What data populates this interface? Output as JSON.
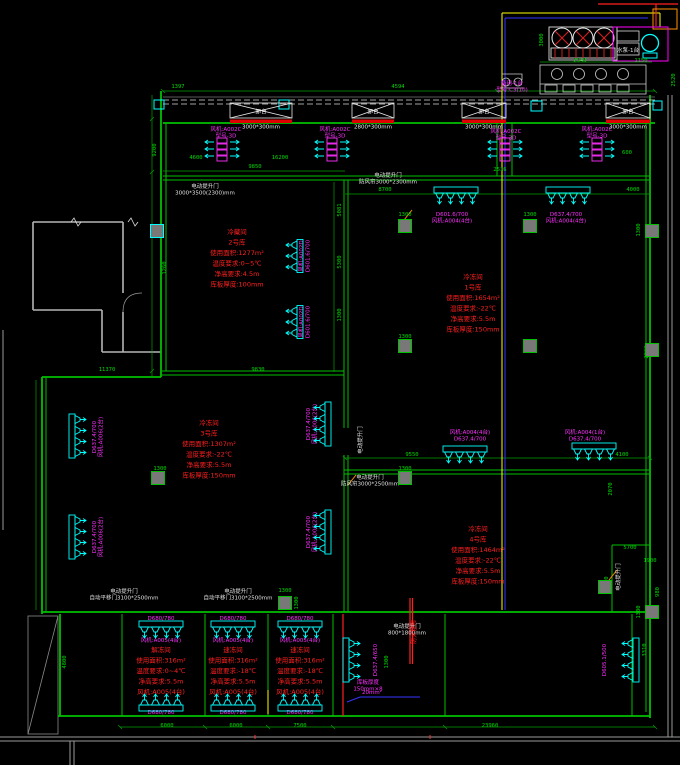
{
  "colors": {
    "background": "#000000",
    "wall_green": "#00c000",
    "dim_green": "#00dc00",
    "equipment_cyan": "#00ffff",
    "fan_magenta": "#ff30ff",
    "spec_red": "#ff2020",
    "note_white": "#e2e2e2",
    "road_gray": "#9a9a9a",
    "pipe_yellow": "#ffff00",
    "pipe_blue": "#3535ff",
    "pipe_red": "#ff2020",
    "pipe_orange": "#ff9000",
    "dock_bar_red": "#e00000"
  },
  "dock": {
    "bay_label": "卸台",
    "bays": [
      {
        "x": 230,
        "w": 62,
        "size": "3000*300mm"
      },
      {
        "x": 352,
        "w": 42,
        "size": "2800*300mm"
      },
      {
        "x": 462,
        "w": 44,
        "size": "3000*300mm"
      },
      {
        "x": 606,
        "w": 44,
        "size": "3000*300mm"
      }
    ]
  },
  "room_specs": [
    {
      "x": 237,
      "y": 234,
      "lines": [
        "冷藏间",
        "2号库",
        "使用面积:1277m²",
        "温度要求:0~5℃",
        "净高要求:4.5m",
        "库板厚度:100mm"
      ]
    },
    {
      "x": 473,
      "y": 279,
      "lines": [
        "冷冻间",
        "1号库",
        "使用面积:1654m²",
        "温度要求:-22℃",
        "净高要求:5.5m",
        "库板厚度:150mm"
      ]
    },
    {
      "x": 209,
      "y": 425,
      "lines": [
        "冷冻间",
        "3号库",
        "使用面积:1307m²",
        "温度要求:-22℃",
        "净高要求:5.5m",
        "库板厚度:150mm"
      ]
    },
    {
      "x": 478,
      "y": 531,
      "lines": [
        "冷冻间",
        "4号库",
        "使用面积:1464m²",
        "温度要求:-22℃",
        "净高要求:5.5m",
        "库板厚度:150mm"
      ]
    },
    {
      "x": 161,
      "y": 652,
      "lines": [
        "解冻间",
        "使用面积:316m²",
        "温度要求:0~4℃",
        "净高要求:5.5m",
        "风机:A005(4台)"
      ]
    },
    {
      "x": 233,
      "y": 652,
      "lines": [
        "速冻间",
        "使用面积:316m²",
        "温度要求:-18℃",
        "净高要求:5.5m",
        "风机:A005(4台)"
      ]
    },
    {
      "x": 300,
      "y": 652,
      "lines": [
        "速冻间",
        "使用面积:316m²",
        "温度要求:-18℃",
        "净高要求:5.5m",
        "风机:A005(4台)"
      ]
    }
  ],
  "red_notes": [
    {
      "x": 416,
      "y": 632,
      "rot": -90,
      "lines": [
        "防火卷帘"
      ]
    }
  ],
  "fan_labels": [
    {
      "x": 226,
      "y": 131,
      "lines": [
        "风机:A002C",
        "型号-3D"
      ]
    },
    {
      "x": 335,
      "y": 131,
      "lines": [
        "风机:A002C",
        "型号-3D"
      ]
    },
    {
      "x": 506,
      "y": 133,
      "lines": [
        "风机:A002C",
        "型号-3D"
      ]
    },
    {
      "x": 597,
      "y": 131,
      "lines": [
        "风机:A002C",
        "型号-3D"
      ]
    },
    {
      "x": 452,
      "y": 216,
      "lines": [
        "D601.6/700",
        "风机:A004(4台)"
      ]
    },
    {
      "x": 566,
      "y": 216,
      "lines": [
        "D637.4/700",
        "风机:A004(4台)"
      ]
    },
    {
      "x": 470,
      "y": 434,
      "lines": [
        "风机:A004(4台)",
        "D637.4/700"
      ]
    },
    {
      "x": 585,
      "y": 434,
      "lines": [
        "风机:A004(1台)",
        "D637.4/700"
      ]
    },
    {
      "x": 96,
      "y": 437,
      "rot": -90,
      "lines": [
        "D637.4/700",
        "风机:A006(2台)"
      ]
    },
    {
      "x": 96,
      "y": 537,
      "rot": -90,
      "lines": [
        "D637.4/700",
        "风机:A006(2台)"
      ]
    },
    {
      "x": 310,
      "y": 424,
      "rot": -90,
      "lines": [
        "D637.4/700",
        "风机:A006(2台)"
      ]
    },
    {
      "x": 310,
      "y": 532,
      "rot": -90,
      "lines": [
        "D637.4/700",
        "风机:A006(2台)"
      ]
    },
    {
      "x": 303,
      "y": 256,
      "rot": -90,
      "lines": [
        "风机:A002D",
        "D601.6/700"
      ]
    },
    {
      "x": 303,
      "y": 322,
      "rot": -90,
      "lines": [
        "风机:A002D",
        "D601.6/700"
      ]
    },
    {
      "x": 161,
      "y": 620,
      "lines": [
        "D680/780"
      ]
    },
    {
      "x": 233,
      "y": 620,
      "lines": [
        "D680/780"
      ]
    },
    {
      "x": 300,
      "y": 620,
      "lines": [
        "D680/780"
      ]
    },
    {
      "x": 161,
      "y": 642,
      "lines": [
        "风机:A005(4台)"
      ]
    },
    {
      "x": 233,
      "y": 642,
      "lines": [
        "风机:A005(4台)"
      ]
    },
    {
      "x": 300,
      "y": 642,
      "lines": [
        "风机:A005(4台)"
      ]
    },
    {
      "x": 161,
      "y": 714,
      "lines": [
        "D680/780"
      ]
    },
    {
      "x": 233,
      "y": 714,
      "lines": [
        "D680/780"
      ]
    },
    {
      "x": 300,
      "y": 714,
      "lines": [
        "D680/780"
      ]
    },
    {
      "x": 377,
      "y": 660,
      "rot": -90,
      "lines": [
        "D637.4/650"
      ]
    },
    {
      "x": 368,
      "y": 684,
      "lines": [
        "库板厚度",
        "150mm×8"
      ]
    },
    {
      "x": 606,
      "y": 660,
      "rot": -90,
      "lines": [
        "D605.1/500"
      ]
    },
    {
      "x": 512,
      "y": 85,
      "lines": [
        "备用-1台",
        "型号:C3(10)"
      ]
    },
    {
      "x": 372,
      "y": 694,
      "lines": [
        "20mm²"
      ]
    }
  ],
  "dims": [
    {
      "x": 178,
      "y": 88,
      "t": "1397"
    },
    {
      "x": 398,
      "y": 88,
      "t": "4594"
    },
    {
      "x": 196,
      "y": 159,
      "t": "4600"
    },
    {
      "x": 280,
      "y": 159,
      "t": "16200"
    },
    {
      "x": 255,
      "y": 168,
      "t": "9850"
    },
    {
      "x": 500,
      "y": 171,
      "t": "2516"
    },
    {
      "x": 385,
      "y": 191,
      "t": "8700"
    },
    {
      "x": 633,
      "y": 191,
      "t": "4000"
    },
    {
      "x": 580,
      "y": 62,
      "t": "2543"
    },
    {
      "x": 641,
      "y": 62,
      "t": "1150"
    },
    {
      "x": 675,
      "y": 80,
      "rot": -90,
      "t": "2520"
    },
    {
      "x": 543,
      "y": 40,
      "rot": -90,
      "t": "3000"
    },
    {
      "x": 156,
      "y": 150,
      "rot": -90,
      "t": "9200"
    },
    {
      "x": 166,
      "y": 268,
      "rot": -90,
      "t": "1260"
    },
    {
      "x": 107,
      "y": 371,
      "t": "11370"
    },
    {
      "x": 258,
      "y": 371,
      "t": "9830"
    },
    {
      "x": 341,
      "y": 210,
      "rot": -90,
      "t": "5081"
    },
    {
      "x": 341,
      "y": 262,
      "rot": -90,
      "t": "5300"
    },
    {
      "x": 341,
      "y": 315,
      "rot": -90,
      "t": "1300"
    },
    {
      "x": 412,
      "y": 456,
      "t": "9550"
    },
    {
      "x": 622,
      "y": 456,
      "t": "4100"
    },
    {
      "x": 612,
      "y": 489,
      "rot": -90,
      "t": "2070"
    },
    {
      "x": 648,
      "y": 352,
      "rot": -90,
      "t": "2030"
    },
    {
      "x": 640,
      "y": 230,
      "rot": -90,
      "t": "1300"
    },
    {
      "x": 627,
      "y": 154,
      "t": "600"
    },
    {
      "x": 405,
      "y": 216,
      "t": "1300"
    },
    {
      "x": 530,
      "y": 216,
      "t": "1300"
    },
    {
      "x": 405,
      "y": 338,
      "t": "1300"
    },
    {
      "x": 405,
      "y": 470,
      "t": "1300"
    },
    {
      "x": 160,
      "y": 470,
      "t": "1300"
    },
    {
      "x": 285,
      "y": 592,
      "t": "1300"
    },
    {
      "x": 298,
      "y": 603,
      "rot": -90,
      "t": "1300"
    },
    {
      "x": 630,
      "y": 549,
      "t": "5700"
    },
    {
      "x": 650,
      "y": 562,
      "t": "1900"
    },
    {
      "x": 608,
      "y": 583,
      "rot": -90,
      "t": "4000"
    },
    {
      "x": 659,
      "y": 592,
      "rot": -90,
      "t": "980"
    },
    {
      "x": 646,
      "y": 650,
      "rot": -90,
      "t": "3310"
    },
    {
      "x": 640,
      "y": 612,
      "rot": -90,
      "t": "1300"
    },
    {
      "x": 167,
      "y": 727,
      "t": "6000"
    },
    {
      "x": 236,
      "y": 727,
      "t": "6000"
    },
    {
      "x": 300,
      "y": 727,
      "t": "7500"
    },
    {
      "x": 490,
      "y": 727,
      "t": "23960"
    },
    {
      "x": 388,
      "y": 662,
      "rot": -90,
      "t": "1300"
    },
    {
      "x": 66,
      "y": 662,
      "rot": -90,
      "t": "4800"
    }
  ],
  "notes": [
    {
      "x": 205,
      "y": 188,
      "lines": [
        "电动提升门",
        "3000*3500(2300)mm"
      ]
    },
    {
      "x": 388,
      "y": 177,
      "lines": [
        "电动提升门",
        "防风帘3000*2300mm"
      ]
    },
    {
      "x": 362,
      "y": 440,
      "rot": -90,
      "lines": [
        "电动提升门"
      ]
    },
    {
      "x": 370,
      "y": 479,
      "lines": [
        "电动提升门",
        "防风帘3000*2500mm"
      ]
    },
    {
      "x": 124,
      "y": 593,
      "lines": [
        "电动提升门",
        "自动平移门3100*2500mm"
      ]
    },
    {
      "x": 238,
      "y": 593,
      "lines": [
        "电动提升门",
        "自动平移门3100*2500mm"
      ]
    },
    {
      "x": 407,
      "y": 628,
      "lines": [
        "电动提升门",
        "800*1800mm"
      ]
    },
    {
      "x": 620,
      "y": 577,
      "rot": -90,
      "lines": [
        "电动提升门"
      ]
    },
    {
      "x": 628,
      "y": 52,
      "lines": [
        "水泵-1台"
      ]
    }
  ],
  "evaporators": [
    {
      "x": 456,
      "y": 196,
      "dir": "down"
    },
    {
      "x": 568,
      "y": 196,
      "dir": "down"
    },
    {
      "x": 465,
      "y": 455,
      "dir": "down"
    },
    {
      "x": 594,
      "y": 452,
      "dir": "down"
    },
    {
      "x": 161,
      "y": 630,
      "dir": "down"
    },
    {
      "x": 233,
      "y": 630,
      "dir": "down"
    },
    {
      "x": 300,
      "y": 630,
      "dir": "down"
    },
    {
      "x": 161,
      "y": 702,
      "dir": "up"
    },
    {
      "x": 233,
      "y": 702,
      "dir": "up"
    },
    {
      "x": 300,
      "y": 702,
      "dir": "up"
    },
    {
      "x": 78,
      "y": 436,
      "dir": "right"
    },
    {
      "x": 78,
      "y": 537,
      "dir": "right"
    },
    {
      "x": 352,
      "y": 660,
      "dir": "right"
    },
    {
      "x": 322,
      "y": 424,
      "dir": "left"
    },
    {
      "x": 322,
      "y": 532,
      "dir": "left"
    },
    {
      "x": 294,
      "y": 256,
      "dir": "left",
      "n": 3
    },
    {
      "x": 294,
      "y": 322,
      "dir": "left",
      "n": 3
    },
    {
      "x": 630,
      "y": 660,
      "dir": "left"
    }
  ],
  "fancoils": [
    {
      "x": 222,
      "y": 150
    },
    {
      "x": 332,
      "y": 150
    },
    {
      "x": 505,
      "y": 150
    },
    {
      "x": 597,
      "y": 150
    }
  ],
  "columns": [
    {
      "x": 405,
      "y": 226,
      "c": "g"
    },
    {
      "x": 530,
      "y": 226,
      "c": "g"
    },
    {
      "x": 652,
      "y": 231,
      "c": "g"
    },
    {
      "x": 405,
      "y": 346,
      "c": "g"
    },
    {
      "x": 530,
      "y": 346,
      "c": "g"
    },
    {
      "x": 652,
      "y": 350,
      "c": "g"
    },
    {
      "x": 405,
      "y": 478,
      "c": "g"
    },
    {
      "x": 158,
      "y": 478,
      "c": "g"
    },
    {
      "x": 285,
      "y": 603,
      "c": "g"
    },
    {
      "x": 605,
      "y": 587,
      "c": "g"
    },
    {
      "x": 652,
      "y": 612,
      "c": "g"
    },
    {
      "x": 157,
      "y": 231,
      "c": "c"
    }
  ]
}
